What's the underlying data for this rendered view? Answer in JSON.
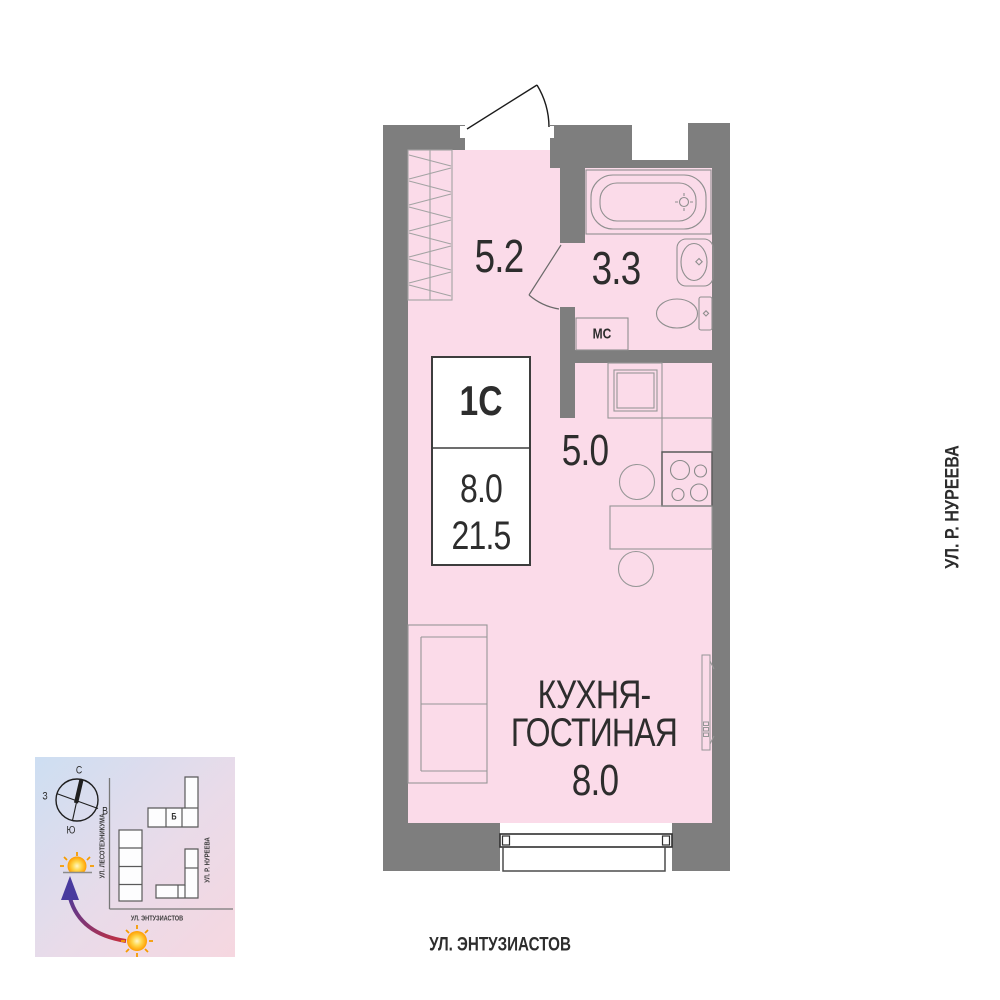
{
  "plan": {
    "info_box": {
      "unit_type": "1С",
      "living_area": "8.0",
      "total_area": "21.5"
    },
    "rooms": {
      "hallway": {
        "area": "5.2"
      },
      "bathroom": {
        "area": "3.3",
        "washer_label": "МС"
      },
      "kitchen": {
        "area": "5.0"
      },
      "living": {
        "name_line1": "КУХНЯ-",
        "name_line2": "ГОСТИНАЯ",
        "area": "8.0"
      }
    }
  },
  "streets": {
    "right_vertical": "УЛ. Р. НУРЕЕВА",
    "bottom": "УЛ. ЭНТУЗИАСТОВ"
  },
  "minimap": {
    "compass": {
      "n": "С",
      "s": "Ю",
      "w": "З",
      "e": "В"
    },
    "building_label": "Б",
    "streets": {
      "left_vertical": "УЛ. ЛЕСОТЕХНИКУМА",
      "right_vertical": "УЛ. Р. НУРЕЕВА",
      "bottom": "УЛ. ЭНТУЗИАСТОВ"
    }
  },
  "colors": {
    "wall": "#7e7e7e",
    "floor": "#fbdbe9",
    "sun": "#ffb300",
    "arrow_start": "#c62f3e",
    "arrow_end": "#483a9e"
  }
}
